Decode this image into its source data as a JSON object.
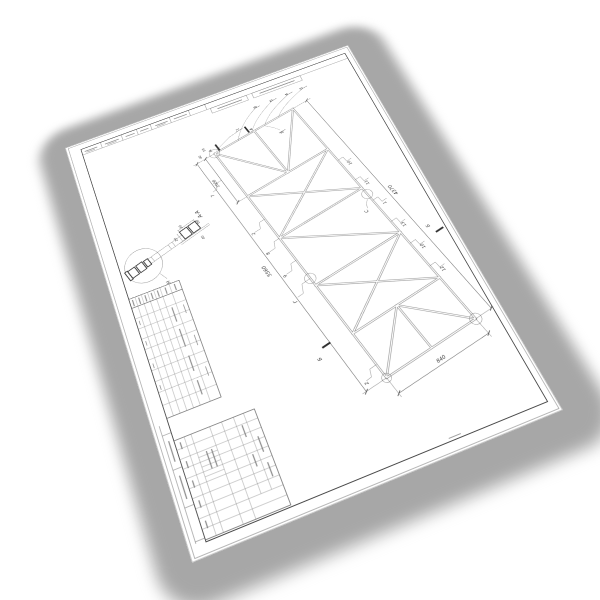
{
  "drawing": {
    "dimensions": {
      "left_overall": "5560",
      "right_overall": "4370",
      "top_panel": "1000",
      "bottom_width": "840",
      "end_offset_a": "50",
      "end_offset_b": "40"
    },
    "section": {
      "title": "А-А",
      "dim_width": "60",
      "dim_top": "30",
      "dim_side": "20",
      "dim_bottom": "40"
    },
    "detail_label": "Н",
    "joint_labels": {
      "right": "С",
      "left": "Г"
    },
    "cut_marks": {
      "top": [
        "А",
        "А"
      ],
      "bottom": [
        "Б",
        "Б"
      ]
    },
    "balloons": {
      "fan": [
        "6",
        "5",
        "4",
        "3"
      ],
      "inner": "8",
      "top": "1",
      "left": [
        "2",
        "8",
        "9"
      ],
      "left_dim": "7",
      "left_bottom": "2",
      "right": [
        "10",
        "11",
        "1",
        "13",
        "10",
        "12"
      ]
    }
  },
  "colors": {
    "paper": "#ffffff",
    "line": "#4a4a4a",
    "shadow": "#a7a7a7",
    "member": "#909090"
  }
}
